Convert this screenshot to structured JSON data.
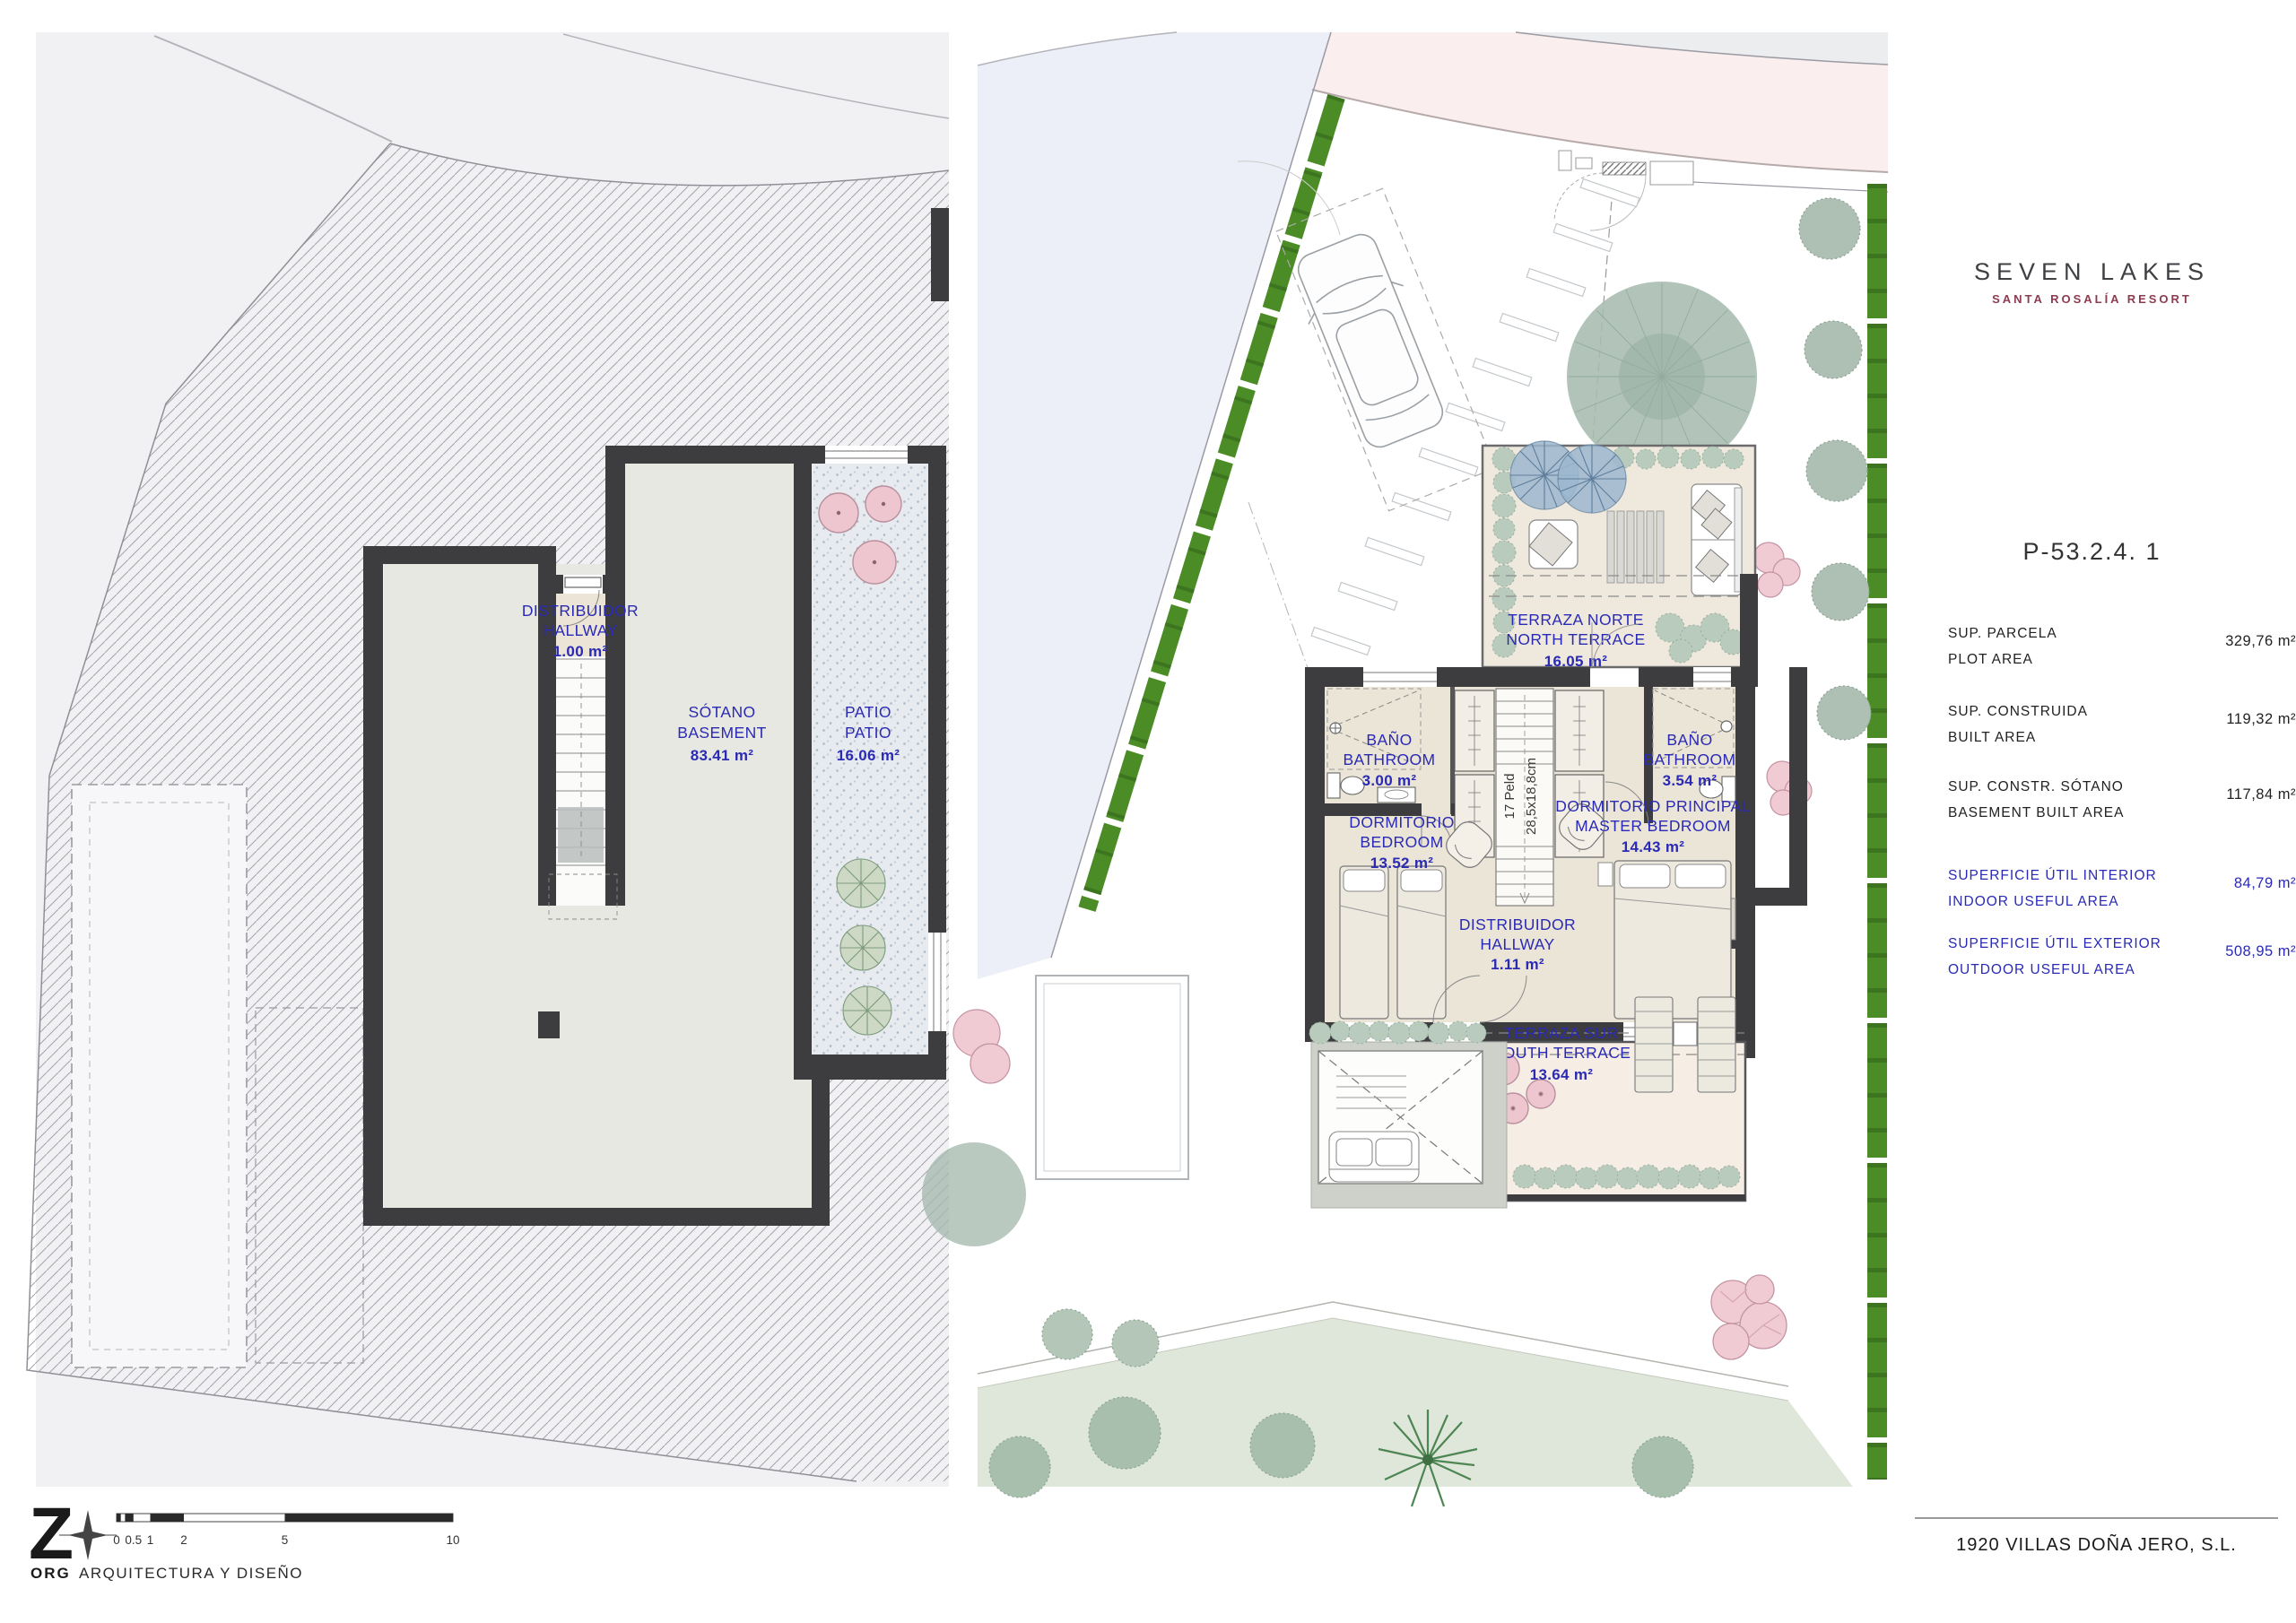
{
  "brand": {
    "name": "SEVEN LAKES",
    "subtitle": "SANTA ROSALÍA RESORT"
  },
  "plot_ref": "P-53.2.4.  1",
  "areas": [
    {
      "label_es": "SUP. PARCELA",
      "label_en": "PLOT AREA",
      "value": "329,76 m²",
      "highlight": false
    },
    {
      "label_es": "SUP. CONSTRUIDA",
      "label_en": "BUILT AREA",
      "value": "119,32 m²",
      "highlight": false
    },
    {
      "label_es": "SUP. CONSTR. SÓTANO",
      "label_en": "BASEMENT BUILT AREA",
      "value": "117,84 m²",
      "highlight": false
    },
    {
      "label_es": "SUPERFICIE ÚTIL INTERIOR",
      "label_en": "INDOOR USEFUL AREA",
      "value": "84,79 m²",
      "highlight": true
    },
    {
      "label_es": "SUPERFICIE ÚTIL EXTERIOR",
      "label_en": "OUTDOOR USEFUL AREA",
      "value": "508,95 m²",
      "highlight": true
    }
  ],
  "rooms": {
    "basement_hallway": {
      "es": "DISTRIBUIDOR",
      "en": "HALLWAY",
      "area": "1.00 m²"
    },
    "basement": {
      "es": "SÓTANO",
      "en": "BASEMENT",
      "area": "83.41 m²"
    },
    "patio": {
      "es": "PATIO",
      "en": "PATIO",
      "area": "16.06 m²"
    },
    "north_terrace": {
      "es": "TERRAZA NORTE",
      "en": "NORTH TERRACE",
      "area": "16.05 m²"
    },
    "bathroom_1": {
      "es": "BAÑO",
      "en": "BATHROOM",
      "area": "3.00 m²"
    },
    "bathroom_2": {
      "es": "BAÑO",
      "en": "BATHROOM",
      "area": "3.54 m²"
    },
    "bedroom": {
      "es": "DORMITORIO",
      "en": "BEDROOM",
      "area": "13.52 m²"
    },
    "master_bedroom": {
      "es": "DORMITORIO PRINCIPAL",
      "en": "MASTER BEDROOM",
      "area": "14.43 m²"
    },
    "hallway": {
      "es": "DISTRIBUIDOR",
      "en": "HALLWAY",
      "area": "1.11 m²"
    },
    "south_terrace": {
      "es": "TERRAZA SUR",
      "en": "SOUTH TERRACE",
      "area": "13.64 m²"
    }
  },
  "stair_note": {
    "line1": "17 Peld",
    "line2": "28,5x18,8cm"
  },
  "architect": {
    "logo": "Z",
    "org": "ORG",
    "name": "ARQUITECTURA Y DISEÑO"
  },
  "developer": "1920 VILLAS DOÑA JERO, S.L.",
  "scale_bar": {
    "ticks": [
      "0",
      "0.5",
      "1",
      "2",
      "5",
      "10"
    ]
  },
  "colors": {
    "accent_blue": "#2a2ab5",
    "wall": "#3d3d40",
    "hedge_green": "#4c8c27",
    "brand_maroon": "#8c3c50",
    "lake_teal": "#2f7f97",
    "lake_sand": "#efe0b4",
    "highlight_plot": "#b9bce8"
  }
}
